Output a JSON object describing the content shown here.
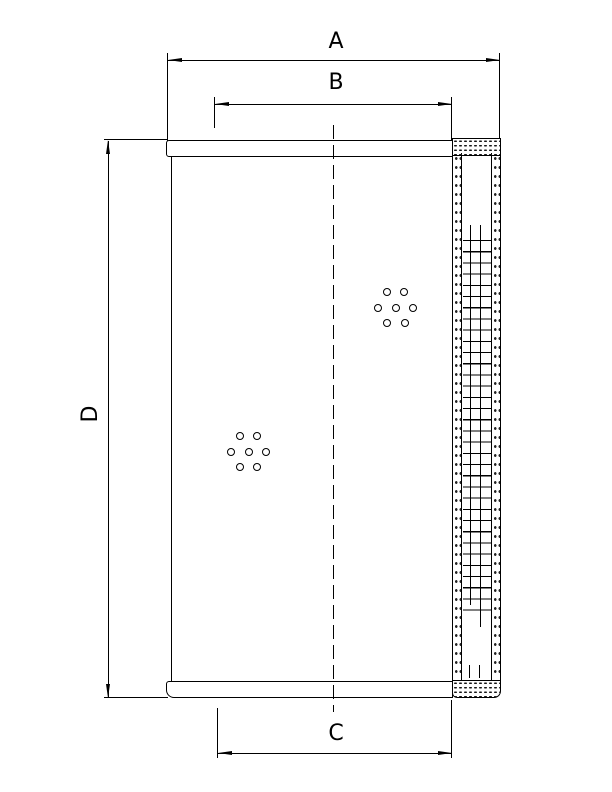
{
  "drawing": {
    "labels": {
      "dim_a": "A",
      "dim_b": "B",
      "dim_c": "C",
      "dim_d": "D"
    },
    "colors": {
      "line": "#000000",
      "background": "#ffffff"
    }
  }
}
